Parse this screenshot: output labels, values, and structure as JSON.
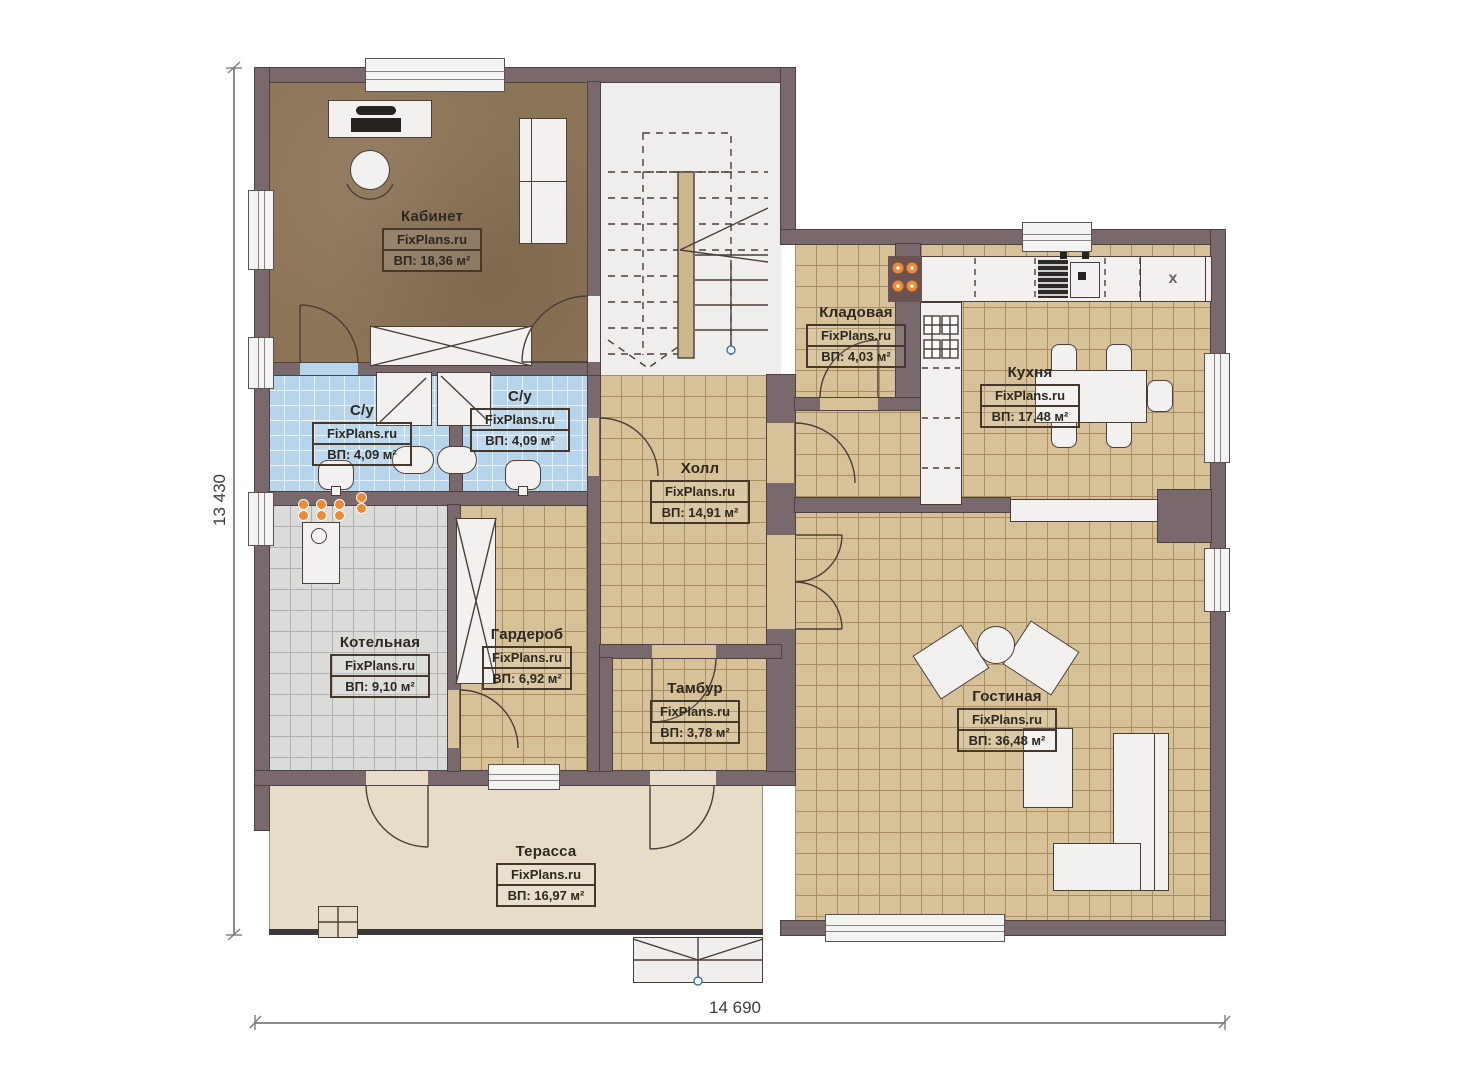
{
  "plan": {
    "brand": "FixPlans.ru",
    "rooms": [
      {
        "name": "Кабинет",
        "area": "ВП: 18,36 м²"
      },
      {
        "name": "С/у",
        "area": "ВП: 4,09 м²"
      },
      {
        "name": "С/у",
        "area": "ВП: 4,09 м²"
      },
      {
        "name": "Кладовая",
        "area": "ВП: 4,03 м²"
      },
      {
        "name": "Кухня",
        "area": "ВП: 17,48 м²"
      },
      {
        "name": "Холл",
        "area": "ВП: 14,91 м²"
      },
      {
        "name": "Котельная",
        "area": "ВП: 9,10 м²"
      },
      {
        "name": "Гардероб",
        "area": "ВП: 6,92 м²"
      },
      {
        "name": "Тамбур",
        "area": "ВП: 3,78 м²"
      },
      {
        "name": "Гостиная",
        "area": "ВП: 36,48 м²"
      },
      {
        "name": "Терасса",
        "area": "ВП: 16,97 м²"
      }
    ],
    "dimensions": {
      "width": "14 690",
      "height": "13 430"
    },
    "kitchen_unit_label": "x",
    "colors": {
      "wall": "#7a696c",
      "wall_outline": "#4c4143",
      "floor_tan": "#d6c199",
      "floor_grid": "#ab8d62",
      "floor_office": "#8c7457",
      "floor_blue": "#b7d4ed",
      "floor_blue_grid": "#e6f1fb",
      "floor_gray": "#dbdbd9",
      "floor_gray_grid": "#b3b1ae",
      "floor_terrace": "#e6dcc8",
      "stairs_floor": "#efeeec",
      "furniture": "#f2f1ef",
      "line": "#4a3f38",
      "label_text": "#2e2820",
      "accent_orange": "#ef8a33",
      "blue_marker": "#3a6fb5"
    }
  }
}
